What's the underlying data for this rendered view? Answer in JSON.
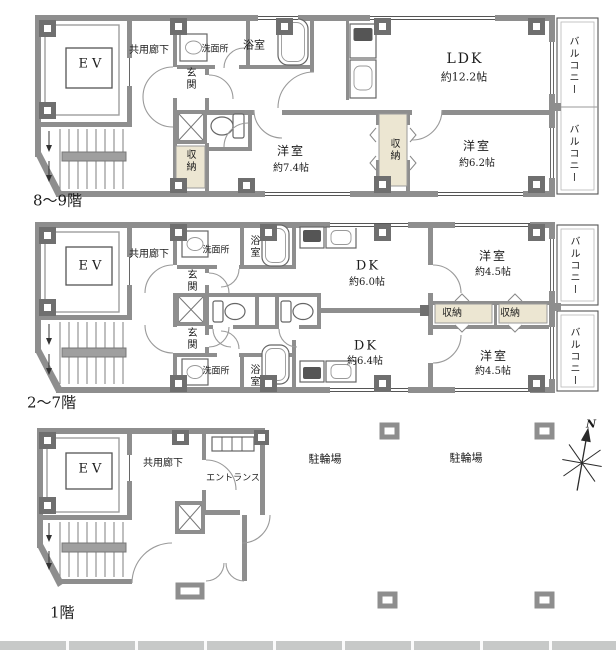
{
  "shared": {
    "ev": "EV",
    "corridor": "共用廊下",
    "genkan": "玄関",
    "washroom": "洗面所",
    "bathroom": "浴室",
    "closet": "収納",
    "western_room": "洋室",
    "balcony": "バルコニー",
    "ldk": "LDK",
    "dk": "DK",
    "entrance_hall": "エントランス",
    "bicycle_parking": "駐輪場",
    "north": "N"
  },
  "floor_top": {
    "label": "8〜9階",
    "ldk_size": "約12.2帖",
    "room_w_size": "約7.4帖",
    "room_e_size": "約6.2帖"
  },
  "floor_mid": {
    "label": "2〜7階",
    "dk_north_size": "約6.0帖",
    "dk_south_size": "約6.4帖",
    "room_ne_size": "約4.5帖",
    "room_se_size": "約4.5帖"
  },
  "floor_bottom": {
    "label": "1階"
  },
  "colors": {
    "wall": "#8e8e8e",
    "pillar": "#6f6f6f",
    "closet_fill": "#ece6d2",
    "band": "#c7c9c8"
  }
}
